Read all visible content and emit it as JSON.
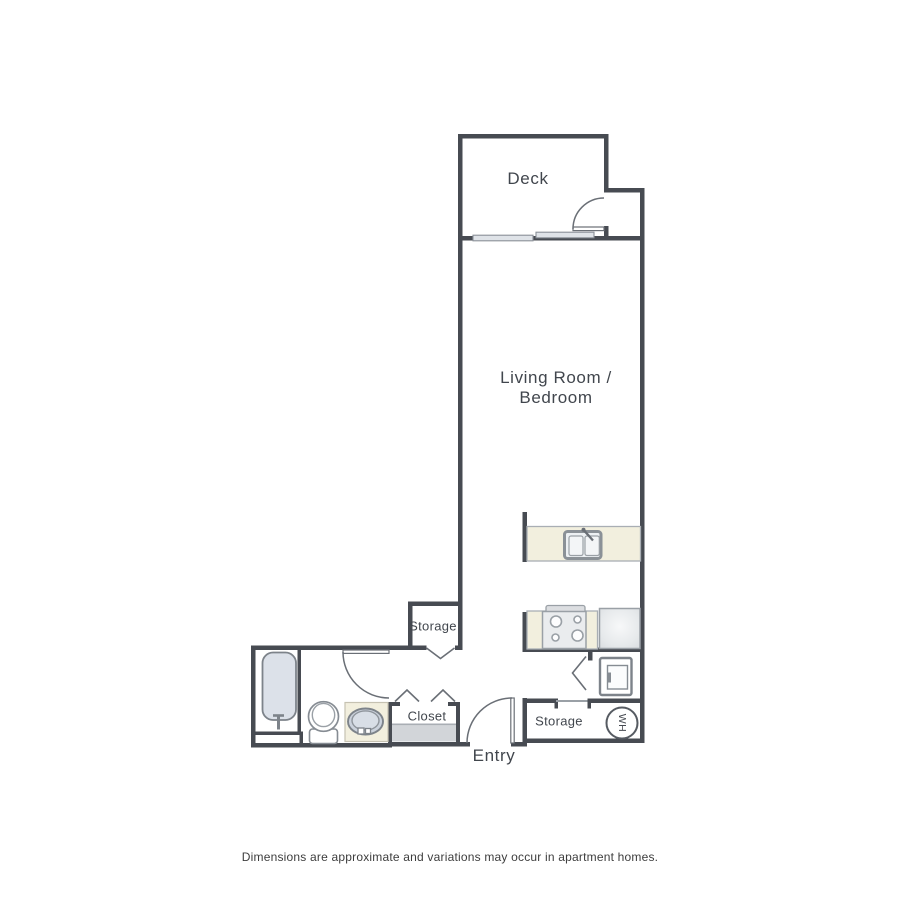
{
  "floor_plan": {
    "rooms": {
      "deck": "Deck",
      "living_line1": "Living Room /",
      "living_line2": "Bedroom",
      "storage_upper": "Storage",
      "closet": "Closet",
      "entry": "Entry",
      "storage_lower": "Storage"
    },
    "fixtures": {
      "water_heater": "WH"
    },
    "footer": "Dimensions are approximate and variations may occur in apartment homes.",
    "colors": {
      "wall": "#474b52",
      "door_line": "#6a6f76",
      "counter_beige": "#f2efde",
      "fixture_outline": "#7d838a",
      "appliance_outline": "#9aa0a6",
      "tub_fill": "#dce1e9",
      "basin_fill": "#cbd2dc",
      "window_fill": "#dfe3e8",
      "closet_floor": "#d2d5d9",
      "label_text": "#41464d"
    }
  }
}
